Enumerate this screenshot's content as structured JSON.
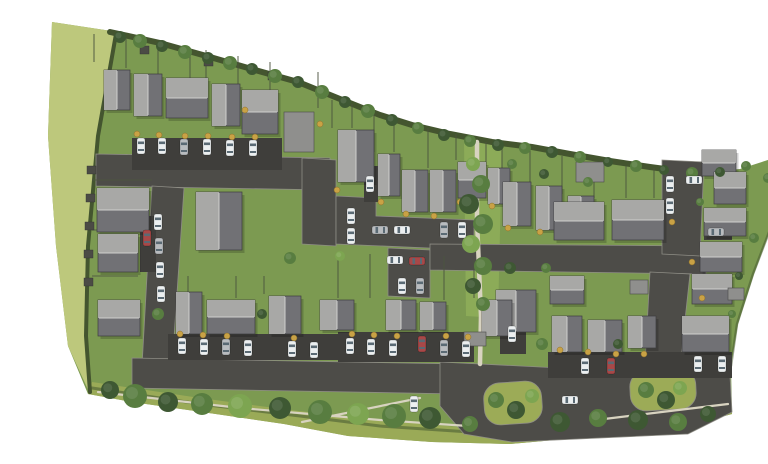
{
  "meta": {
    "label": "Aerial site plan rendering of a residential housing development"
  },
  "palette": {
    "background": "#ffffff",
    "grass": "#7c9a51",
    "field": "#bdc87c",
    "verge": "#9cab57",
    "corridor": "#8cab58",
    "road": "#4d4c48",
    "drive": "#3f3e3b",
    "curb": "#8e8d85",
    "path": "#d8d3c0",
    "hedge": "#44552f",
    "fence": "#4d5540",
    "shed": "#4b4b45",
    "shrub": "#c9a245",
    "tree_dark": "#3e5833",
    "tree_mid": "#587d40",
    "tree_light": "#7da551",
    "roof_light": "#a8a8a6",
    "roof_dark": "#717175",
    "roof_ridge": "#cfcfcd",
    "roof_edge": "#3e3e3e",
    "garage_roof": "#8f8f8d",
    "car_white": "#eceff0",
    "car_silver": "#b9bcbf",
    "car_black": "#323539",
    "car_red": "#a84848",
    "glass": "#5a6a74",
    "shadow": "rgba(0,0,0,0.18)"
  },
  "ground": {
    "site": [
      [
        12,
        6
      ],
      [
        78,
        16
      ],
      [
        120,
        27
      ],
      [
        170,
        41
      ],
      [
        215,
        54
      ],
      [
        258,
        66
      ],
      [
        300,
        83
      ],
      [
        340,
        99
      ],
      [
        372,
        109
      ],
      [
        410,
        118
      ],
      [
        452,
        126
      ],
      [
        492,
        131
      ],
      [
        530,
        138
      ],
      [
        570,
        145
      ],
      [
        610,
        151
      ],
      [
        655,
        157
      ],
      [
        700,
        153
      ],
      [
        762,
        133
      ],
      [
        737,
        196
      ],
      [
        714,
        258
      ],
      [
        698,
        308
      ],
      [
        691,
        350
      ],
      [
        692,
        398
      ],
      [
        640,
        412
      ],
      [
        560,
        420
      ],
      [
        470,
        428
      ],
      [
        392,
        426
      ],
      [
        308,
        420
      ],
      [
        244,
        408
      ],
      [
        162,
        396
      ],
      [
        92,
        386
      ],
      [
        48,
        378
      ],
      [
        28,
        330
      ],
      [
        16,
        230
      ],
      [
        8,
        120
      ]
    ],
    "field": [
      [
        12,
        6
      ],
      [
        78,
        16
      ],
      [
        60,
        110
      ],
      [
        50,
        210
      ],
      [
        46,
        300
      ],
      [
        50,
        378
      ],
      [
        28,
        330
      ],
      [
        16,
        230
      ],
      [
        8,
        120
      ]
    ],
    "verge": [
      [
        52,
        366
      ],
      [
        160,
        382
      ],
      [
        250,
        394
      ],
      [
        340,
        404
      ],
      [
        430,
        412
      ],
      [
        520,
        408
      ],
      [
        610,
        396
      ],
      [
        690,
        382
      ],
      [
        692,
        398
      ],
      [
        640,
        412
      ],
      [
        560,
        420
      ],
      [
        470,
        428
      ],
      [
        392,
        426
      ],
      [
        308,
        420
      ],
      [
        244,
        408
      ],
      [
        162,
        396
      ],
      [
        92,
        386
      ],
      [
        48,
        378
      ]
    ],
    "corridor": [
      [
        424,
        124
      ],
      [
        462,
        128
      ],
      [
        458,
        302
      ],
      [
        426,
        300
      ]
    ]
  },
  "hedges": [
    {
      "d": "M 70,16 L 120,27 L 170,41 L 215,54 L 258,66 L 300,83 L 340,99 L 372,109 L 410,118 L 452,126 L 492,131 L 530,138 L 570,145 L 610,151 L 655,157 L 692,155",
      "w": 6,
      "o": 1
    },
    {
      "d": "M 76,18 L 58,120 L 48,230 L 46,320 L 50,376",
      "w": 4,
      "o": 1
    },
    {
      "d": "M 52,372 L 160,388 L 260,400 L 340,410 L 430,416",
      "w": 3,
      "o": 0.55
    },
    {
      "d": "M 760,136 L 736,198 L 713,258 L 697,308 L 691,350",
      "w": 2.5,
      "o": 0.5
    }
  ],
  "roads": [
    [
      [
        56,
        138
      ],
      [
        290,
        142
      ],
      [
        290,
        174
      ],
      [
        56,
        170
      ]
    ],
    [
      [
        112,
        170
      ],
      [
        144,
        172
      ],
      [
        132,
        352
      ],
      [
        102,
        350
      ]
    ],
    [
      [
        262,
        142
      ],
      [
        296,
        144
      ],
      [
        296,
        230
      ],
      [
        262,
        228
      ]
    ],
    [
      [
        296,
        180
      ],
      [
        336,
        182
      ],
      [
        336,
        200
      ],
      [
        434,
        204
      ],
      [
        434,
        234
      ],
      [
        296,
        228
      ]
    ],
    [
      [
        348,
        232
      ],
      [
        390,
        234
      ],
      [
        390,
        282
      ],
      [
        348,
        280
      ]
    ],
    [
      [
        390,
        228
      ],
      [
        666,
        230
      ],
      [
        666,
        258
      ],
      [
        390,
        254
      ]
    ],
    [
      [
        622,
        144
      ],
      [
        664,
        146
      ],
      [
        660,
        240
      ],
      [
        622,
        238
      ]
    ],
    [
      [
        610,
        256
      ],
      [
        650,
        258
      ],
      [
        638,
        368
      ],
      [
        604,
        366
      ]
    ],
    [
      [
        92,
        342
      ],
      [
        420,
        348
      ],
      [
        420,
        378
      ],
      [
        92,
        372
      ]
    ],
    [
      [
        400,
        346
      ],
      [
        560,
        354
      ],
      [
        690,
        360
      ],
      [
        692,
        396
      ],
      [
        648,
        418
      ],
      [
        560,
        422
      ],
      [
        472,
        426
      ],
      [
        424,
        418
      ],
      [
        400,
        390
      ]
    ]
  ],
  "islands": [
    [
      444,
      366,
      58,
      42,
      16,
      -4
    ],
    [
      590,
      354,
      66,
      40,
      16,
      -3
    ]
  ],
  "drives": [
    [
      92,
      122,
      150,
      32
    ],
    [
      128,
      318,
      178,
      26
    ],
    [
      298,
      316,
      136,
      30
    ],
    [
      508,
      336,
      184,
      26
    ],
    [
      100,
      200,
      16,
      56
    ],
    [
      324,
      150,
      14,
      36
    ],
    [
      460,
      316,
      26,
      22
    ],
    [
      664,
      208,
      28,
      16
    ]
  ],
  "paths": [
    {
      "d": "M 437,126 L 437,204 L 441,300 L 440,348",
      "w": 4.5
    },
    {
      "d": "M 58,376 L 200,392 L 340,404 L 428,410",
      "w": 2.2
    },
    {
      "d": "M 262,406 L 380,382",
      "w": 2.2
    },
    {
      "d": "M 556,404 L 688,388",
      "w": 2.2
    }
  ],
  "fences": [
    [
      54,
      18,
      54,
      46
    ],
    [
      86,
      22,
      86,
      52
    ],
    [
      118,
      26,
      118,
      60
    ],
    [
      150,
      32,
      150,
      64
    ],
    [
      166,
      34,
      166,
      68
    ],
    [
      198,
      40,
      198,
      74
    ],
    [
      230,
      46,
      230,
      80
    ],
    [
      278,
      56,
      278,
      92
    ],
    [
      292,
      84,
      292,
      112
    ],
    [
      312,
      88,
      312,
      112
    ],
    [
      334,
      94,
      334,
      136
    ],
    [
      354,
      100,
      354,
      136
    ],
    [
      388,
      112,
      388,
      152
    ],
    [
      416,
      118,
      416,
      144
    ],
    [
      446,
      126,
      446,
      150
    ],
    [
      462,
      130,
      462,
      164
    ],
    [
      490,
      134,
      490,
      168
    ],
    [
      522,
      140,
      522,
      178
    ],
    [
      554,
      146,
      554,
      182
    ],
    [
      586,
      150,
      586,
      182
    ],
    [
      614,
      152,
      614,
      182
    ],
    [
      298,
      238,
      298,
      282
    ],
    [
      330,
      238,
      330,
      282
    ],
    [
      404,
      240,
      404,
      284
    ],
    [
      434,
      244,
      434,
      282
    ],
    [
      148,
      260,
      148,
      276
    ],
    [
      196,
      260,
      196,
      282
    ],
    [
      224,
      260,
      224,
      278
    ],
    [
      52,
      164,
      112,
      164
    ],
    [
      52,
      214,
      98,
      214
    ],
    [
      52,
      260,
      98,
      260
    ]
  ],
  "sheds": [
    [
      47,
      150
    ],
    [
      46,
      178
    ],
    [
      45,
      206
    ],
    [
      44,
      234
    ],
    [
      44,
      262
    ],
    [
      100,
      30
    ],
    [
      164,
      42
    ],
    [
      228,
      56
    ]
  ],
  "houses": [
    [
      64,
      54,
      26,
      40,
      "v"
    ],
    [
      94,
      58,
      28,
      42,
      "v"
    ],
    [
      126,
      62,
      42,
      40,
      "h"
    ],
    [
      172,
      68,
      28,
      42,
      "v"
    ],
    [
      202,
      74,
      36,
      44,
      "h"
    ],
    [
      298,
      114,
      36,
      52,
      "v"
    ],
    [
      338,
      138,
      22,
      42,
      "v"
    ],
    [
      362,
      154,
      26,
      42,
      "v"
    ],
    [
      390,
      154,
      26,
      42,
      "v"
    ],
    [
      418,
      146,
      28,
      36,
      "h"
    ],
    [
      448,
      152,
      22,
      36,
      "v"
    ],
    [
      463,
      166,
      28,
      44,
      "v"
    ],
    [
      496,
      170,
      26,
      44,
      "v"
    ],
    [
      528,
      180,
      26,
      40,
      "v"
    ],
    [
      662,
      134,
      34,
      26,
      "h"
    ],
    [
      674,
      156,
      32,
      32,
      "h"
    ],
    [
      664,
      192,
      42,
      28,
      "h"
    ],
    [
      660,
      226,
      42,
      30,
      "h"
    ],
    [
      652,
      258,
      40,
      30,
      "h"
    ],
    [
      514,
      186,
      50,
      38,
      "h"
    ],
    [
      572,
      184,
      52,
      40,
      "h"
    ],
    [
      510,
      260,
      34,
      28,
      "h"
    ],
    [
      456,
      274,
      40,
      42,
      "v"
    ],
    [
      280,
      284,
      34,
      30,
      "v"
    ],
    [
      346,
      284,
      30,
      30,
      "v"
    ],
    [
      380,
      286,
      26,
      28,
      "v"
    ],
    [
      442,
      284,
      30,
      36,
      "v"
    ],
    [
      57,
      172,
      52,
      44,
      "h"
    ],
    [
      58,
      218,
      40,
      38,
      "h"
    ],
    [
      156,
      176,
      46,
      58,
      "v"
    ],
    [
      58,
      284,
      42,
      36,
      "h"
    ],
    [
      136,
      276,
      26,
      42,
      "v"
    ],
    [
      167,
      284,
      48,
      34,
      "h"
    ],
    [
      229,
      280,
      32,
      38,
      "v"
    ],
    [
      512,
      300,
      30,
      36,
      "v"
    ],
    [
      548,
      304,
      34,
      32,
      "v"
    ],
    [
      588,
      300,
      28,
      32,
      "v"
    ],
    [
      642,
      300,
      47,
      36,
      "h"
    ]
  ],
  "garages": [
    [
      244,
      96,
      30,
      40
    ],
    [
      536,
      146,
      28,
      20
    ],
    [
      590,
      264,
      18,
      14
    ],
    [
      424,
      316,
      22,
      14
    ],
    [
      688,
      272,
      16,
      12
    ]
  ],
  "shrubs": [
    [
      97,
      118
    ],
    [
      119,
      119
    ],
    [
      145,
      120
    ],
    [
      168,
      120
    ],
    [
      192,
      121
    ],
    [
      215,
      121
    ],
    [
      297,
      174
    ],
    [
      341,
      186
    ],
    [
      366,
      198
    ],
    [
      394,
      200
    ],
    [
      420,
      186
    ],
    [
      452,
      190
    ],
    [
      468,
      212
    ],
    [
      500,
      216
    ],
    [
      140,
      318
    ],
    [
      163,
      319
    ],
    [
      187,
      320
    ],
    [
      254,
      322
    ],
    [
      312,
      318
    ],
    [
      334,
      319
    ],
    [
      357,
      320
    ],
    [
      406,
      320
    ],
    [
      428,
      321
    ],
    [
      520,
      334
    ],
    [
      548,
      336
    ],
    [
      576,
      338
    ],
    [
      604,
      338
    ],
    [
      632,
      206
    ],
    [
      652,
      246
    ],
    [
      662,
      282
    ],
    [
      280,
      108
    ],
    [
      205,
      94
    ]
  ],
  "trees": [
    [
      80,
      21,
      6,
      "d"
    ],
    [
      100,
      25,
      7,
      "m"
    ],
    [
      122,
      30,
      6,
      "d"
    ],
    [
      145,
      36,
      7,
      "m"
    ],
    [
      168,
      42,
      6,
      "d"
    ],
    [
      190,
      47,
      7,
      "m"
    ],
    [
      212,
      53,
      6,
      "d"
    ],
    [
      235,
      60,
      7,
      "m"
    ],
    [
      258,
      66,
      6,
      "d"
    ],
    [
      282,
      76,
      7,
      "m"
    ],
    [
      305,
      86,
      6,
      "d"
    ],
    [
      328,
      95,
      7,
      "m"
    ],
    [
      352,
      104,
      6,
      "d"
    ],
    [
      378,
      112,
      6,
      "m"
    ],
    [
      404,
      119,
      6,
      "d"
    ],
    [
      430,
      125,
      6,
      "m"
    ],
    [
      458,
      129,
      6,
      "d"
    ],
    [
      485,
      132,
      6,
      "m"
    ],
    [
      512,
      136,
      6,
      "d"
    ],
    [
      540,
      141,
      6,
      "m"
    ],
    [
      568,
      146,
      5,
      "d"
    ],
    [
      596,
      150,
      6,
      "m"
    ],
    [
      624,
      154,
      5,
      "d"
    ],
    [
      652,
      157,
      6,
      "m"
    ],
    [
      680,
      156,
      5,
      "d"
    ],
    [
      706,
      150,
      5,
      "m"
    ],
    [
      728,
      162,
      5,
      "m"
    ],
    [
      742,
      184,
      4,
      "d"
    ],
    [
      714,
      222,
      5,
      "m"
    ],
    [
      699,
      260,
      4,
      "d"
    ],
    [
      692,
      298,
      4,
      "m"
    ],
    [
      70,
      374,
      9,
      "d"
    ],
    [
      95,
      380,
      12,
      "m"
    ],
    [
      128,
      386,
      10,
      "d"
    ],
    [
      162,
      388,
      11,
      "m"
    ],
    [
      200,
      390,
      12,
      "l"
    ],
    [
      240,
      392,
      11,
      "d"
    ],
    [
      280,
      396,
      12,
      "m"
    ],
    [
      318,
      398,
      11,
      "l"
    ],
    [
      354,
      400,
      12,
      "m"
    ],
    [
      390,
      402,
      11,
      "d"
    ],
    [
      430,
      408,
      8,
      "m"
    ],
    [
      520,
      406,
      10,
      "d"
    ],
    [
      558,
      402,
      9,
      "m"
    ],
    [
      598,
      404,
      10,
      "d"
    ],
    [
      638,
      406,
      9,
      "m"
    ],
    [
      668,
      398,
      8,
      "d"
    ],
    [
      456,
      384,
      8,
      "m"
    ],
    [
      476,
      394,
      9,
      "d"
    ],
    [
      492,
      380,
      7,
      "l"
    ],
    [
      606,
      374,
      8,
      "m"
    ],
    [
      626,
      384,
      9,
      "d"
    ],
    [
      640,
      372,
      7,
      "l"
    ],
    [
      433,
      148,
      7,
      "l"
    ],
    [
      441,
      168,
      9,
      "m"
    ],
    [
      429,
      188,
      10,
      "d"
    ],
    [
      443,
      208,
      10,
      "m"
    ],
    [
      431,
      228,
      9,
      "l"
    ],
    [
      443,
      250,
      9,
      "m"
    ],
    [
      433,
      270,
      8,
      "d"
    ],
    [
      443,
      288,
      7,
      "m"
    ],
    [
      472,
      148,
      5,
      "m"
    ],
    [
      504,
      158,
      5,
      "d"
    ],
    [
      548,
      166,
      5,
      "m"
    ],
    [
      250,
      242,
      6,
      "m"
    ],
    [
      470,
      252,
      6,
      "d"
    ],
    [
      506,
      252,
      5,
      "m"
    ],
    [
      118,
      298,
      6,
      "m"
    ],
    [
      222,
      298,
      5,
      "d"
    ],
    [
      502,
      328,
      6,
      "m"
    ],
    [
      578,
      328,
      5,
      "d"
    ],
    [
      660,
      186,
      4,
      "m"
    ],
    [
      300,
      240,
      5,
      "l"
    ]
  ],
  "cars": [
    [
      101,
      130,
      "v",
      "w"
    ],
    [
      122,
      130,
      "v",
      "w"
    ],
    [
      144,
      131,
      "v",
      "s"
    ],
    [
      167,
      131,
      "v",
      "w"
    ],
    [
      190,
      132,
      "v",
      "w"
    ],
    [
      213,
      132,
      "v",
      "w"
    ],
    [
      118,
      206,
      "v",
      "w"
    ],
    [
      119,
      230,
      "v",
      "s"
    ],
    [
      120,
      254,
      "v",
      "w"
    ],
    [
      121,
      278,
      "v",
      "w"
    ],
    [
      107,
      222,
      "v",
      "r"
    ],
    [
      311,
      200,
      "v",
      "w"
    ],
    [
      311,
      220,
      "v",
      "w"
    ],
    [
      340,
      214,
      "h",
      "s"
    ],
    [
      362,
      214,
      "h",
      "w"
    ],
    [
      404,
      214,
      "v",
      "s"
    ],
    [
      422,
      214,
      "v",
      "w"
    ],
    [
      355,
      244,
      "h",
      "w"
    ],
    [
      377,
      245,
      "h",
      "r"
    ],
    [
      362,
      270,
      "v",
      "w"
    ],
    [
      380,
      270,
      "v",
      "s"
    ],
    [
      142,
      330,
      "v",
      "w"
    ],
    [
      164,
      331,
      "v",
      "w"
    ],
    [
      186,
      331,
      "v",
      "s"
    ],
    [
      208,
      332,
      "v",
      "w"
    ],
    [
      252,
      333,
      "v",
      "w"
    ],
    [
      274,
      334,
      "v",
      "w"
    ],
    [
      310,
      330,
      "v",
      "w"
    ],
    [
      331,
      331,
      "v",
      "w"
    ],
    [
      353,
      332,
      "v",
      "w"
    ],
    [
      382,
      328,
      "v",
      "r"
    ],
    [
      404,
      332,
      "v",
      "s"
    ],
    [
      426,
      333,
      "v",
      "w"
    ],
    [
      630,
      168,
      "v",
      "w"
    ],
    [
      630,
      190,
      "v",
      "w"
    ],
    [
      654,
      164,
      "h",
      "w"
    ],
    [
      676,
      216,
      "h",
      "s"
    ],
    [
      545,
      350,
      "v",
      "w"
    ],
    [
      571,
      350,
      "v",
      "r"
    ],
    [
      658,
      348,
      "v",
      "w"
    ],
    [
      682,
      348,
      "v",
      "w"
    ],
    [
      530,
      384,
      "h",
      "w"
    ],
    [
      374,
      388,
      "v",
      "w"
    ],
    [
      330,
      168,
      "v",
      "w"
    ],
    [
      472,
      318,
      "v",
      "w"
    ]
  ]
}
